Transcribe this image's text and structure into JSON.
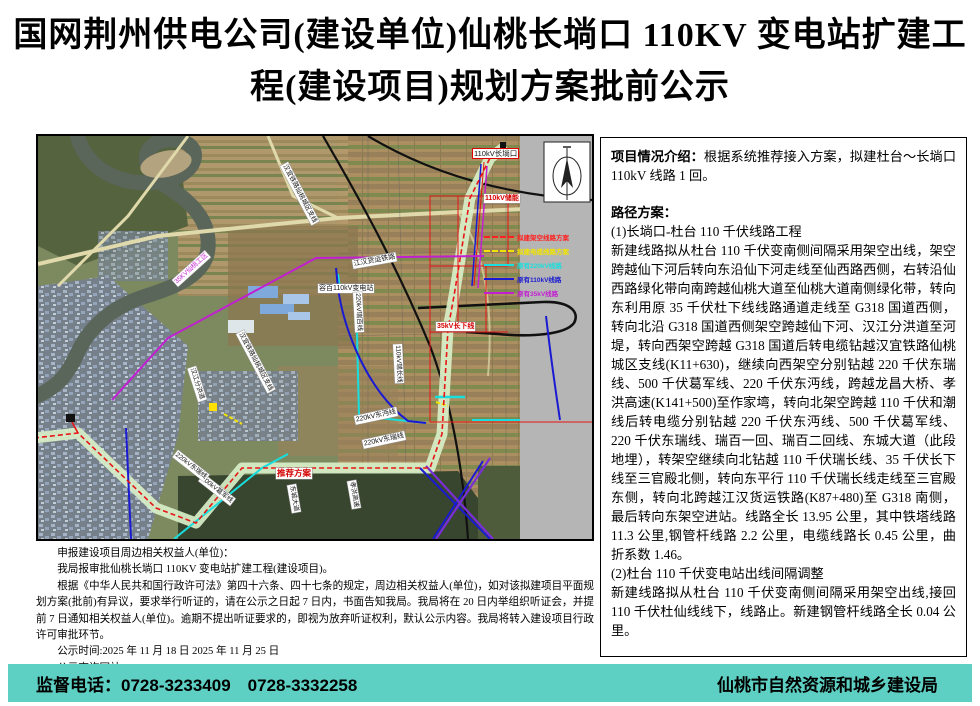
{
  "title": {
    "line1": "国网荆州供电公司(建设单位)仙桃长埫口 110KV 变电站扩建工",
    "line2": "程(建设项目)规划方案批前公示"
  },
  "map": {
    "compass": "north-arrow",
    "labels": [
      {
        "text": "110kV长埫口",
        "x": 434,
        "y": 12,
        "rot": 0,
        "cls": "red-border"
      },
      {
        "text": "110kV储能",
        "x": 446,
        "y": 58,
        "rot": 0,
        "cls": "red-text"
      },
      {
        "text": "江汉货运铁路",
        "x": 314,
        "y": 124,
        "rot": -10,
        "cls": ""
      },
      {
        "text": "容百110kV变电站",
        "x": 280,
        "y": 148,
        "rot": 0,
        "cls": ""
      },
      {
        "text": "35kV长下线",
        "x": 398,
        "y": 186,
        "rot": 0,
        "cls": "red-text"
      },
      {
        "text": "220kV瑞百线",
        "x": 324,
        "y": 156,
        "rot": 87,
        "cls": "tiny"
      },
      {
        "text": "110kV瑞长线",
        "x": 364,
        "y": 208,
        "rot": 87,
        "cls": "tiny"
      },
      {
        "text": "汉宜铁路仙桃城区支线",
        "x": 250,
        "y": 26,
        "rot": 62,
        "cls": "tiny"
      },
      {
        "text": "汉宜铁路仙桃城区支线",
        "x": 206,
        "y": 194,
        "rot": 62,
        "cls": "tiny"
      },
      {
        "text": "汉江分洪道",
        "x": 158,
        "y": 230,
        "rot": 72,
        "cls": "tiny"
      },
      {
        "text": "35KV仙桃工区",
        "x": 134,
        "y": 144,
        "rot": -42,
        "cls": "magenta-text tiny"
      },
      {
        "text": "220kV东沔线",
        "x": 316,
        "y": 280,
        "rot": -12,
        "cls": ""
      },
      {
        "text": "220kV东瑞线",
        "x": 324,
        "y": 304,
        "rot": -12,
        "cls": ""
      },
      {
        "text": "推荐方案",
        "x": 238,
        "y": 332,
        "rot": 0,
        "cls": "red-text strong"
      },
      {
        "text": "500kV葛军线",
        "x": 166,
        "y": 338,
        "rot": 38,
        "cls": "tiny"
      },
      {
        "text": "220kV东瑞线",
        "x": 140,
        "y": 314,
        "rot": 38,
        "cls": "tiny"
      },
      {
        "text": "孝洪高速",
        "x": 318,
        "y": 344,
        "rot": 80,
        "cls": "tiny"
      },
      {
        "text": "东城大道",
        "x": 258,
        "y": 348,
        "rot": 80,
        "cls": "tiny"
      }
    ],
    "legend": [
      {
        "label": "拟建架空线路方案",
        "color": "#ff2020",
        "dash": true
      },
      {
        "label": "拟建电缆线路方案",
        "color": "#f2e400",
        "dash": true
      },
      {
        "label": "原有220kV线路",
        "color": "#18dede",
        "dash": false
      },
      {
        "label": "原有110kV线路",
        "color": "#1a1ad2",
        "dash": false
      },
      {
        "label": "原有35kV线路",
        "color": "#c21fd2",
        "dash": false
      }
    ]
  },
  "info_panel": {
    "intro_label": "项目情况介绍：",
    "intro_text": "根据系统推荐接入方案，拟建杜台～长埫口 110kV 线路 1 回。",
    "section_title": "路径方案：",
    "item1_title": "(1)长埫口-杜台 110 千伏线路工程",
    "item1_body": "新建线路拟从杜台 110 千伏变南侧间隔采用架空出线，架空跨越仙下河后转向东沿仙下河走线至仙西路西侧，右转沿仙西路绿化带向南跨越仙桃大道至仙桃大道南侧绿化带，转向东利用原 35 千伏杜下线线路通道走线至 G318 国道西侧，转向北沿 G318 国道西侧架空跨越仙下河、汉江分洪道至河堤，转向西架空跨越 G318 国道后转电缆钻越汉宜铁路仙桃城区支线(K11+630)，继续向西架空分别钻越 220 千伏东瑞线、500 千伏葛军线、220 千伏东沔线，跨越龙昌大桥、孝洪高速(K141+500)至作家塆，转向北架空跨越 110 千伏和潮线后转电缆分别钻越 220 千伏东沔线、500 千伏葛军线、220 千伏东瑞线、瑞百一回、瑞百二回线、东城大道（此段地埋），转架空继续向北钻越 110 千伏瑞长线、35 千伏长下线至三官殿北侧，转向东平行 110 千伏瑞长线走线至三官殿东侧，转向北跨越江汉货运铁路(K87+480)至 G318 南侧，最后转向东架空进站。线路全长 13.95 公里，其中铁塔线路 11.3 公里,钢管杆线路 2.2 公里，电缆线路长 0.45 公里，曲折系数 1.46。",
    "item2_title": "(2)杜台 110 千伏变电站出线间隔调整",
    "item2_body": "新建线路拟从杜台 110 千伏变南侧间隔采用架空出线,接回 110 千伏杜仙线线下，线路止。新建钢管杆线路全长 0.04 公里。"
  },
  "notice": {
    "line1": "申报建设项目周边相关权益人(单位)：",
    "line2": "我局报审批仙桃长埫口 110KV 变电站扩建工程(建设项目)。",
    "para": "根据《中华人民共和国行政许可法》第四十六条、四十七条的规定，周边相关权益人(单位)，如对该拟建项目平面规划方案(批前)有异议，要求举行听证的，请在公示之日起 7 日内，书面告知我局。我局将在 20 日内举组织听证会，并提前 7 日通知相关权益人(单位)。逾期不提出听证要求的，即视为放弃听证权利，默认公示内容。我局将转入建设项目行政许可审批环节。",
    "time_line": "公示时间:2025 年 11 月 18 日 2025 年 11 月 25 日",
    "site_line": "公示查询网站:http://gtj.xiantao.mov.cn"
  },
  "footer": {
    "phone_label": "监督电话：0728-3233409　0728-3332258",
    "agency": "仙桃市自然资源和城乡建设局",
    "bg_color": "#5dd0c3"
  }
}
